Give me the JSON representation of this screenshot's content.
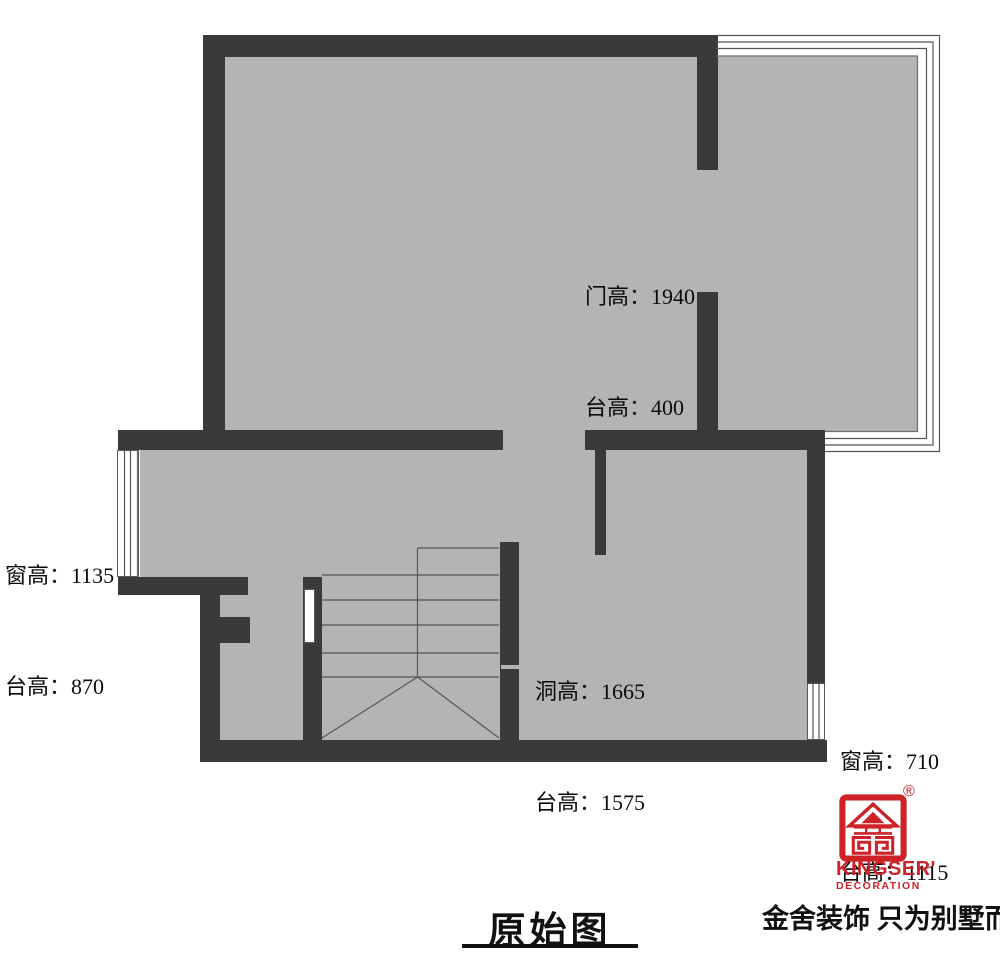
{
  "plan": {
    "title": "原始图",
    "annotations": {
      "door_top": {
        "line1": "门高：1940",
        "line2": "台高：400"
      },
      "window_left": {
        "line1": "窗高：1135",
        "line2": "台高：870"
      },
      "opening_mid": {
        "line1": "洞高：1665",
        "line2": "台高：1575"
      },
      "window_right": {
        "line1": "窗高：710",
        "line2": "台高：1115"
      }
    }
  },
  "brand": {
    "name": "KINGSER'",
    "subtitle": "DECORATION",
    "registered": "®",
    "tagline": "金舍装饰 只为别墅而生。"
  },
  "colors": {
    "wall": "#3a3a3c",
    "floor": "#b4b4b4",
    "linework": "#5a5a5e",
    "brand_red": "#cd2227"
  }
}
